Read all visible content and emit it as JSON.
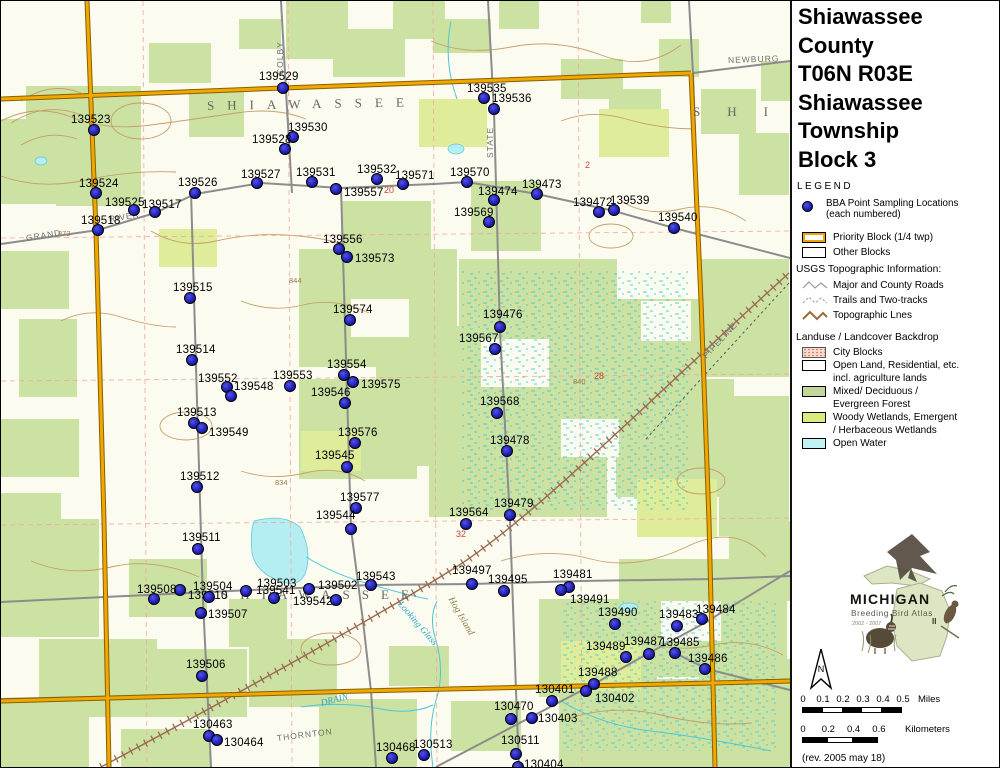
{
  "panel": {
    "title_lines": [
      "Shiawassee",
      "County",
      "T06N R03E",
      "Shiawassee",
      "Township",
      "Block 3"
    ],
    "legend_title": "LEGEND",
    "legend": {
      "point_item": {
        "line1": "BBA Point Sampling Locations",
        "line2": "(each numbered)"
      },
      "blocks": [
        {
          "swatch": "priority",
          "label": "Priority Block (1/4 twp)"
        },
        {
          "swatch": "other",
          "label": "Other Blocks"
        }
      ],
      "usgs_header": "USGS Topographic Information:",
      "usgs_items": [
        {
          "swatch": "road-line",
          "label": "Major and County Roads"
        },
        {
          "swatch": "trail-line",
          "label": "Trails and Two-tracks"
        },
        {
          "swatch": "topo-line",
          "label": "Topographic Lnes"
        }
      ],
      "landuse_header": "Landuse / Landcover Backdrop",
      "landuse_items": [
        {
          "swatch": "city",
          "lines": [
            "City Blocks"
          ]
        },
        {
          "swatch": "open",
          "lines": [
            "Open Land, Residential, etc.",
            "incl. agriculture lands"
          ]
        },
        {
          "swatch": "forest",
          "lines": [
            "Mixed/ Deciduous /",
            "Evergreen Forest"
          ]
        },
        {
          "swatch": "wetland",
          "lines": [
            "Woody Wetlands, Emergent",
            "/ Herbaceous Wetlands"
          ]
        },
        {
          "swatch": "water",
          "lines": [
            "Open Water"
          ]
        }
      ]
    },
    "logo": {
      "name": "MICHIGAN",
      "subtitle": "Breeding Bird Atlas",
      "years": "2002 - 2007",
      "numeral": "II"
    },
    "north_label": "N",
    "scalebars": [
      {
        "unit": "Miles",
        "ticks": [
          "0",
          "0.1",
          "0.2",
          "0.3",
          "0.4",
          "0.5"
        ]
      },
      {
        "unit": "Kilometers",
        "ticks": [
          "0",
          "0.2",
          "0.4",
          "0.6"
        ]
      }
    ],
    "revision": "(rev. 2005 may 18)"
  },
  "map": {
    "colors": {
      "priority_block": "#efa400",
      "sampling_point": "#2a2ac4",
      "forest": "#cbe2a3",
      "wetland": "#dfec9a",
      "water": "#b5eef2"
    },
    "points": [
      [
        "139529",
        282,
        87,
        258,
        76
      ],
      [
        "139523",
        93,
        129,
        70,
        119
      ],
      [
        "139530",
        292,
        136,
        287,
        127
      ],
      [
        "139528",
        284,
        148,
        251,
        139
      ],
      [
        "139527",
        256,
        182,
        240,
        174
      ],
      [
        "139531",
        311,
        181,
        295,
        172
      ],
      [
        "139532",
        376,
        178,
        356,
        169
      ],
      [
        "139571",
        402,
        183,
        394,
        175
      ],
      [
        "139570",
        466,
        181,
        449,
        172
      ],
      [
        "139524",
        95,
        192,
        78,
        183
      ],
      [
        "139526",
        194,
        192,
        177,
        182
      ],
      [
        "139557",
        335,
        188,
        343,
        192
      ],
      [
        "139525",
        133,
        209,
        104,
        202
      ],
      [
        "139517",
        154,
        211,
        141,
        204
      ],
      [
        "139518",
        97,
        229,
        80,
        220
      ],
      [
        "139535",
        483,
        97,
        466,
        88
      ],
      [
        "139536",
        493,
        108,
        491,
        98
      ],
      [
        "139474",
        493,
        199,
        477,
        191
      ],
      [
        "139473",
        536,
        193,
        521,
        184
      ],
      [
        "139472",
        598,
        211,
        572,
        202
      ],
      [
        "139539",
        613,
        209,
        609,
        200
      ],
      [
        "139569",
        488,
        221,
        453,
        212
      ],
      [
        "139540",
        673,
        227,
        657,
        217
      ],
      [
        "139556",
        338,
        248,
        322,
        239
      ],
      [
        "139573",
        346,
        256,
        354,
        258
      ],
      [
        "139515",
        189,
        297,
        172,
        287
      ],
      [
        "139574",
        349,
        319,
        332,
        309
      ],
      [
        "139514",
        191,
        359,
        175,
        349
      ],
      [
        "139552",
        226,
        386,
        197,
        378
      ],
      [
        "139548",
        230,
        395,
        233,
        386
      ],
      [
        "139553",
        289,
        385,
        272,
        375
      ],
      [
        "139554",
        343,
        374,
        326,
        364
      ],
      [
        "139575",
        352,
        381,
        360,
        384
      ],
      [
        "139546",
        344,
        402,
        310,
        392
      ],
      [
        "139513",
        193,
        422,
        176,
        412
      ],
      [
        "139549",
        201,
        427,
        208,
        432
      ],
      [
        "139576",
        354,
        442,
        337,
        432
      ],
      [
        "139545",
        346,
        466,
        314,
        455
      ],
      [
        "139512",
        196,
        486,
        179,
        476
      ],
      [
        "139577",
        355,
        507,
        339,
        497
      ],
      [
        "139476",
        499,
        326,
        482,
        314
      ],
      [
        "139567",
        494,
        348,
        458,
        338
      ],
      [
        "139568",
        496,
        412,
        479,
        401
      ],
      [
        "139478",
        506,
        450,
        489,
        440
      ],
      [
        "139479",
        509,
        514,
        493,
        503
      ],
      [
        "139564",
        465,
        523,
        448,
        512
      ],
      [
        "139544",
        350,
        528,
        315,
        515
      ],
      [
        "139511",
        197,
        548,
        181,
        537
      ],
      [
        "139543",
        370,
        584,
        355,
        576
      ],
      [
        "139502",
        308,
        588,
        317,
        585
      ],
      [
        "139503",
        245,
        590,
        256,
        583
      ],
      [
        "139541",
        273,
        597,
        255,
        590
      ],
      [
        "139542",
        335,
        599,
        292,
        601
      ],
      [
        "139504",
        179,
        589,
        192,
        586
      ],
      [
        "139510",
        208,
        596,
        187,
        595
      ],
      [
        "139508",
        153,
        598,
        136,
        589
      ],
      [
        "139507",
        200,
        612,
        207,
        614
      ],
      [
        "139506",
        201,
        675,
        185,
        664
      ],
      [
        "130463",
        208,
        735,
        192,
        724
      ],
      [
        "130464",
        216,
        739,
        223,
        742
      ],
      [
        "139497",
        471,
        583,
        451,
        570
      ],
      [
        "139495",
        503,
        590,
        487,
        579
      ],
      [
        "139481",
        568,
        586,
        552,
        574
      ],
      [
        "139491",
        560,
        589,
        569,
        599
      ],
      [
        "139490",
        614,
        623,
        597,
        612
      ],
      [
        "139483",
        676,
        625,
        658,
        614
      ],
      [
        "139484",
        701,
        618,
        695,
        609
      ],
      [
        "139489",
        625,
        656,
        585,
        646
      ],
      [
        "139487",
        648,
        653,
        623,
        641
      ],
      [
        "139485",
        674,
        652,
        659,
        642
      ],
      [
        "139486",
        704,
        668,
        687,
        658
      ],
      [
        "139488",
        593,
        683,
        577,
        672
      ],
      [
        "130402",
        585,
        690,
        594,
        698
      ],
      [
        "130401",
        551,
        700,
        534,
        689
      ],
      [
        "130470",
        510,
        718,
        493,
        706
      ],
      [
        "130403",
        531,
        717,
        537,
        718
      ],
      [
        "130511",
        515,
        753,
        500,
        740
      ],
      [
        "130404",
        517,
        766,
        523,
        764
      ],
      [
        "130468",
        391,
        757,
        375,
        747
      ],
      [
        "130513",
        423,
        754,
        412,
        744
      ]
    ],
    "texts": [
      {
        "t": "SHIAWASSEE",
        "x": 206,
        "y": 106,
        "r": -1,
        "c": "town",
        "ls": 13
      },
      {
        "t": "SHI",
        "x": 692,
        "y": 112,
        "r": 0,
        "c": "town",
        "ls": 27
      },
      {
        "t": "SHIAWASSEE",
        "x": 220,
        "y": 595,
        "r": 0,
        "c": "town",
        "ls": 12
      },
      {
        "t": "NEWBURG",
        "x": 727,
        "y": 60,
        "r": -2,
        "c": "road"
      },
      {
        "t": "STATE",
        "x": 489,
        "y": 158,
        "r": -90,
        "c": "road"
      },
      {
        "t": "COLBY",
        "x": 279,
        "y": 75,
        "r": -90,
        "c": "road"
      },
      {
        "t": "GRAND",
        "x": 25,
        "y": 238,
        "r": -9,
        "c": "road"
      },
      {
        "t": "RIVER",
        "x": 108,
        "y": 219,
        "r": -9,
        "c": "road"
      },
      {
        "t": "PIPELINE",
        "x": 703,
        "y": 357,
        "r": -47,
        "c": "road"
      },
      {
        "t": "THORNTON",
        "x": 276,
        "y": 738,
        "r": -7,
        "c": "road"
      },
      {
        "t": "DRAIN",
        "x": 320,
        "y": 704,
        "r": -14,
        "c": "wat"
      },
      {
        "t": "Looking Glass",
        "x": 398,
        "y": 603,
        "r": 49,
        "c": "wat"
      },
      {
        "t": "Hog Island",
        "x": 449,
        "y": 598,
        "r": 60,
        "c": "topo"
      },
      {
        "t": "20",
        "x": 383,
        "y": 190,
        "r": 0,
        "c": "sec"
      },
      {
        "t": "2",
        "x": 584,
        "y": 165,
        "r": 0,
        "c": "sec"
      },
      {
        "t": "32",
        "x": 455,
        "y": 534,
        "r": 0,
        "c": "sec"
      },
      {
        "t": "28",
        "x": 593,
        "y": 376,
        "r": 0,
        "c": "sec"
      },
      {
        "t": "844",
        "x": 288,
        "y": 281,
        "r": 0,
        "c": "elev"
      },
      {
        "t": "840",
        "x": 572,
        "y": 382,
        "r": 0,
        "c": "elev"
      },
      {
        "t": "834",
        "x": 274,
        "y": 483,
        "r": 0,
        "c": "elev"
      },
      {
        "t": "872",
        "x": 57,
        "y": 234,
        "r": 0,
        "c": "elev"
      }
    ]
  }
}
